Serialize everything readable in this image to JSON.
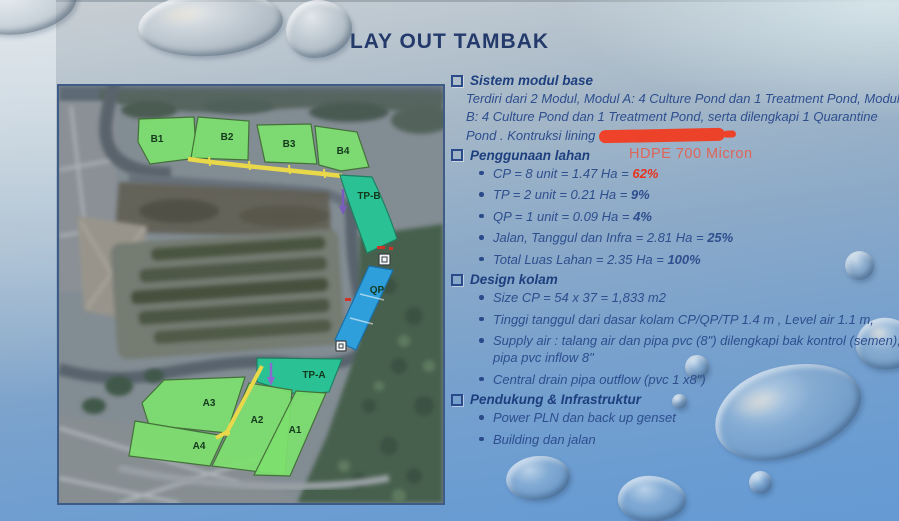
{
  "slide": {
    "title": "LAY OUT TAMBAK"
  },
  "colors": {
    "title_blue": "#233a6b",
    "body_blue": "#2e4e8e",
    "accent_red": "#e8341f",
    "redaction_red": "#f23d22",
    "pond_green": "#7de06e",
    "pond_teal": "#2ac294",
    "pond_blue": "#2f9fdb",
    "road_yellow": "#ead84b"
  },
  "map": {
    "pond_labels": {
      "b1": "B1",
      "b2": "B2",
      "b3": "B3",
      "b4": "B4",
      "tpb": "TP-B",
      "qp": "QP",
      "tpa": "TP-A",
      "a1": "A1",
      "a2": "A2",
      "a3": "A3",
      "a4": "A4"
    }
  },
  "sections": [
    {
      "heading": "Sistem modul base",
      "body": "Terdiri dari 2 Modul, Modul A: 4 Culture Pond dan 1 Treatment Pond, Modul B: 4 Culture Pond dan 1 Treatment Pond, serta dilengkapi  1 Quarantine Pond . Kontruksi lining",
      "note": "HDPE 700 Micron"
    },
    {
      "heading": "Penggunaan lahan",
      "bullets": [
        {
          "text": "CP = 8 unit =  1.47 Ha = ",
          "pct": "62%"
        },
        {
          "text": "TP = 2 unit =  0.21 Ha =  ",
          "pct": "9%"
        },
        {
          "text": "QP = 1 unit = 0.09 Ha = ",
          "pct": "4%"
        },
        {
          "text": "Jalan, Tanggul dan  Infra =  2.81 Ha = ",
          "pct": "25%"
        },
        {
          "text": "Total Luas Lahan =  2.35 Ha = ",
          "pct": "100%"
        }
      ]
    },
    {
      "heading": "Design kolam",
      "bullets": [
        {
          "text": "Size CP = 54 x 37 = 1,833 m2"
        },
        {
          "text": "Tinggi tanggul  dari dasar kolam CP/QP/TP 1.4 m , Level air 1.1 m,"
        },
        {
          "text": "Supply air : talang air dan pipa pvc (8\") dilengkapi bak kontrol (semen), pipa pvc inflow 8\""
        },
        {
          "text": "Central drain pipa outflow (pvc 1 x8\")"
        }
      ]
    },
    {
      "heading": "Pendukung & Infrastruktur",
      "bullets": [
        {
          "text": "Power PLN dan back up genset"
        },
        {
          "text": "Building dan jalan"
        }
      ]
    }
  ]
}
